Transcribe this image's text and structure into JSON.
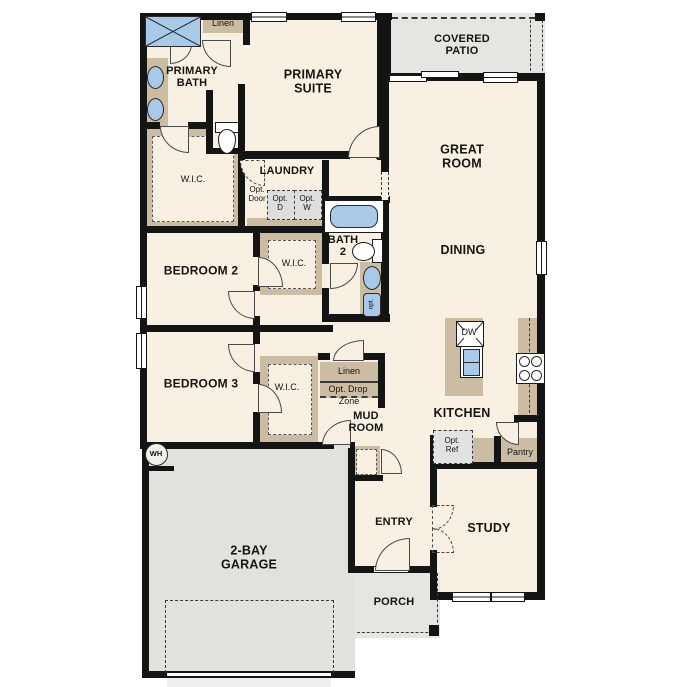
{
  "plan_type": "single-story floor plan",
  "colors": {
    "floor": "#f8f1e3",
    "outdoor": "#e6e5e1",
    "wall": "#141414",
    "cabinet_tan": "#cbbca3",
    "fixture_blue": "#a9c9e9",
    "option_gray": "#dedede"
  },
  "labels": {
    "linen_top": "Linen",
    "primary_bath": "PRIMARY\nBATH",
    "primary_suite": "PRIMARY\nSUITE",
    "covered_patio": "COVERED\nPATIO",
    "great_room": "GREAT\nROOM",
    "wic": "W.I.C.",
    "laundry": "LAUNDRY",
    "opt_door": "Opt.\nDoor",
    "opt_d": "Opt.\nD",
    "opt_w": "Opt.\nW",
    "bath2": "BATH\n2",
    "dining": "DINING",
    "bedroom2": "BEDROOM 2",
    "bedroom3": "BEDROOM 3",
    "linen_mid": "Linen",
    "opt_drop": "Opt. Drop",
    "zone": "Zone",
    "mud_room": "MUD\nROOM",
    "kitchen": "KITCHEN",
    "dw": "DW",
    "opt_ref": "Opt.\nRef",
    "pantry": "Pantry",
    "opt_small": "opt.",
    "wh": "WH",
    "garage": "2-BAY\nGARAGE",
    "entry": "ENTRY",
    "study": "STUDY",
    "porch": "PORCH"
  }
}
